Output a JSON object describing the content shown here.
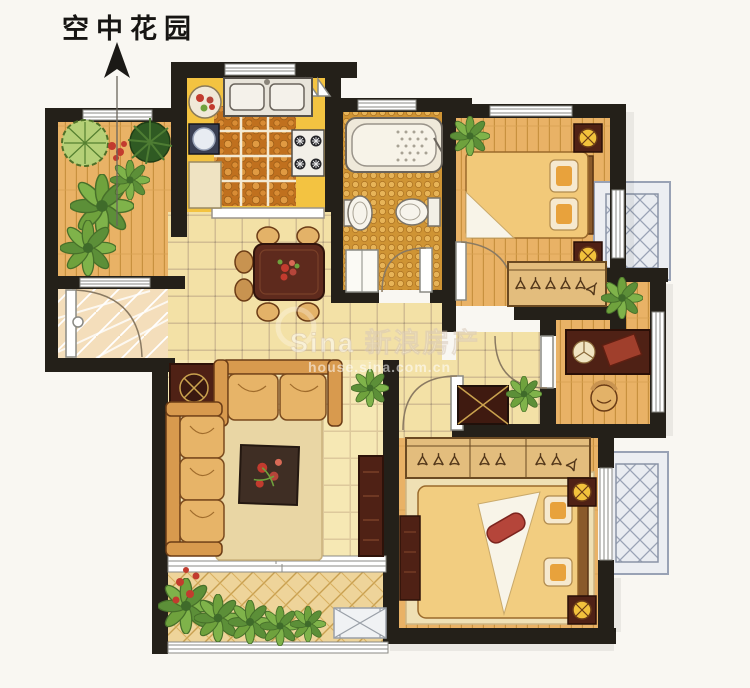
{
  "annotation": {
    "label": "空中花园",
    "arrow_direction": "up"
  },
  "watermark": {
    "line1": "Sina 新浪房产",
    "line2": "house.sina.com.cn"
  },
  "palette": {
    "paper": "#f9f7f2",
    "wall": "#242019",
    "wood_floor": "#e9b266",
    "plank_line": "#c8913f",
    "hall_tile": "#f3e1a6",
    "living_tile": "#f6e8b4",
    "kitchen_counter": "#f3c341",
    "pebble_floor": "#c0701e",
    "mosaic_floor": "#cf9434",
    "herringbone": "#eed49a",
    "carpet": "#e9d6a4",
    "rug": "#3f2e24",
    "flower_red": "#c23b2e",
    "furniture_dark": "#4f2115",
    "sofa_tan": "#e0a95e",
    "bed_yellow": "#f2cc7c",
    "plant_green": "#6fa23d",
    "bay_frame": "#99a2b5",
    "window_white": "#ffffff"
  },
  "rooms": [
    {
      "id": "sky-garden",
      "furniture": [
        "round-tree",
        "pine-plant",
        "fern-plants",
        "red-flowers",
        "wood-deck"
      ]
    },
    {
      "id": "entry-hall",
      "furniture": [
        "entry-door-arc",
        "diagonal-tile-floor"
      ]
    },
    {
      "id": "kitchen",
      "furniture": [
        "double-sink",
        "gas-stove",
        "washing-machine",
        "flower-plate",
        "cabinet",
        "folding-door",
        "pebble-floor"
      ]
    },
    {
      "id": "bathroom",
      "furniture": [
        "bathtub",
        "pedestal-sink",
        "toilet",
        "cabinet",
        "door-arc",
        "mosaic-floor"
      ]
    },
    {
      "id": "bedroom-north",
      "furniture": [
        "double-bed",
        "nightstand-lamps",
        "hanger-closet",
        "plant",
        "door-arc"
      ]
    },
    {
      "id": "study",
      "furniture": [
        "desk",
        "blotter",
        "chair",
        "plant",
        "door-arc",
        "window"
      ]
    },
    {
      "id": "hallway",
      "furniture": [
        "shoe-cabinet",
        "plant",
        "floor-tiles"
      ]
    },
    {
      "id": "dining-area",
      "furniture": [
        "dining-table",
        "six-chairs",
        "flower-centerpiece"
      ]
    },
    {
      "id": "living-room",
      "furniture": [
        "sofa-3seat",
        "sofa-2seat",
        "corner-lamp-table",
        "carpet",
        "flower-rug",
        "tv-cabinet",
        "plant"
      ]
    },
    {
      "id": "master-bedroom",
      "furniture": [
        "double-bed",
        "red-bolster",
        "nightstand-lamps",
        "hanger-wardrobe",
        "dresser",
        "carpet",
        "door-arc"
      ]
    },
    {
      "id": "balcony",
      "furniture": [
        "herringbone-tiles",
        "plants",
        "red-flowers",
        "ac-platform",
        "railing"
      ]
    },
    {
      "id": "bay-window-north",
      "furniture": [
        "x-brace-hatch"
      ]
    },
    {
      "id": "bay-window-south",
      "furniture": [
        "x-brace-hatch"
      ]
    }
  ]
}
